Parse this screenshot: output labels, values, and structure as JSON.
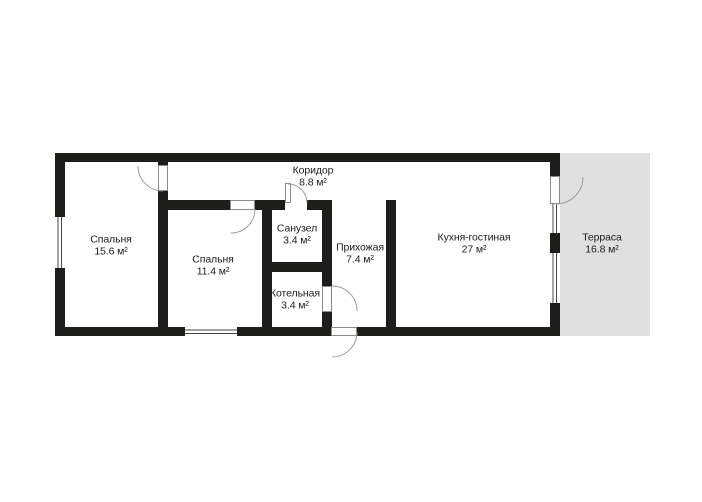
{
  "floor_plan": {
    "rooms": [
      {
        "id": "bedroom-1",
        "name": "Спальня",
        "area": "15.6 м²"
      },
      {
        "id": "bedroom-2",
        "name": "Спальня",
        "area": "11.4 м²"
      },
      {
        "id": "bathroom",
        "name": "Санузел",
        "area": "3.4 м²"
      },
      {
        "id": "corridor",
        "name": "Коридор",
        "area": "8.8 м²"
      },
      {
        "id": "hallway",
        "name": "Прихожая",
        "area": "7.4 м²"
      },
      {
        "id": "boiler",
        "name": "Котельная",
        "area": "3.4 м²"
      },
      {
        "id": "kitchen",
        "name": "Кухня-гостиная",
        "area": "27 м²"
      },
      {
        "id": "terrace",
        "name": "Терраса",
        "area": "16.8 м²"
      }
    ],
    "colors": {
      "background": "#ffffff",
      "wall": "#1d1d1b",
      "terrace_fill": "#e0e0e0",
      "label_text": "#1c1c1c",
      "door_line": "#9a9a9a",
      "window_line": "#444444"
    }
  }
}
